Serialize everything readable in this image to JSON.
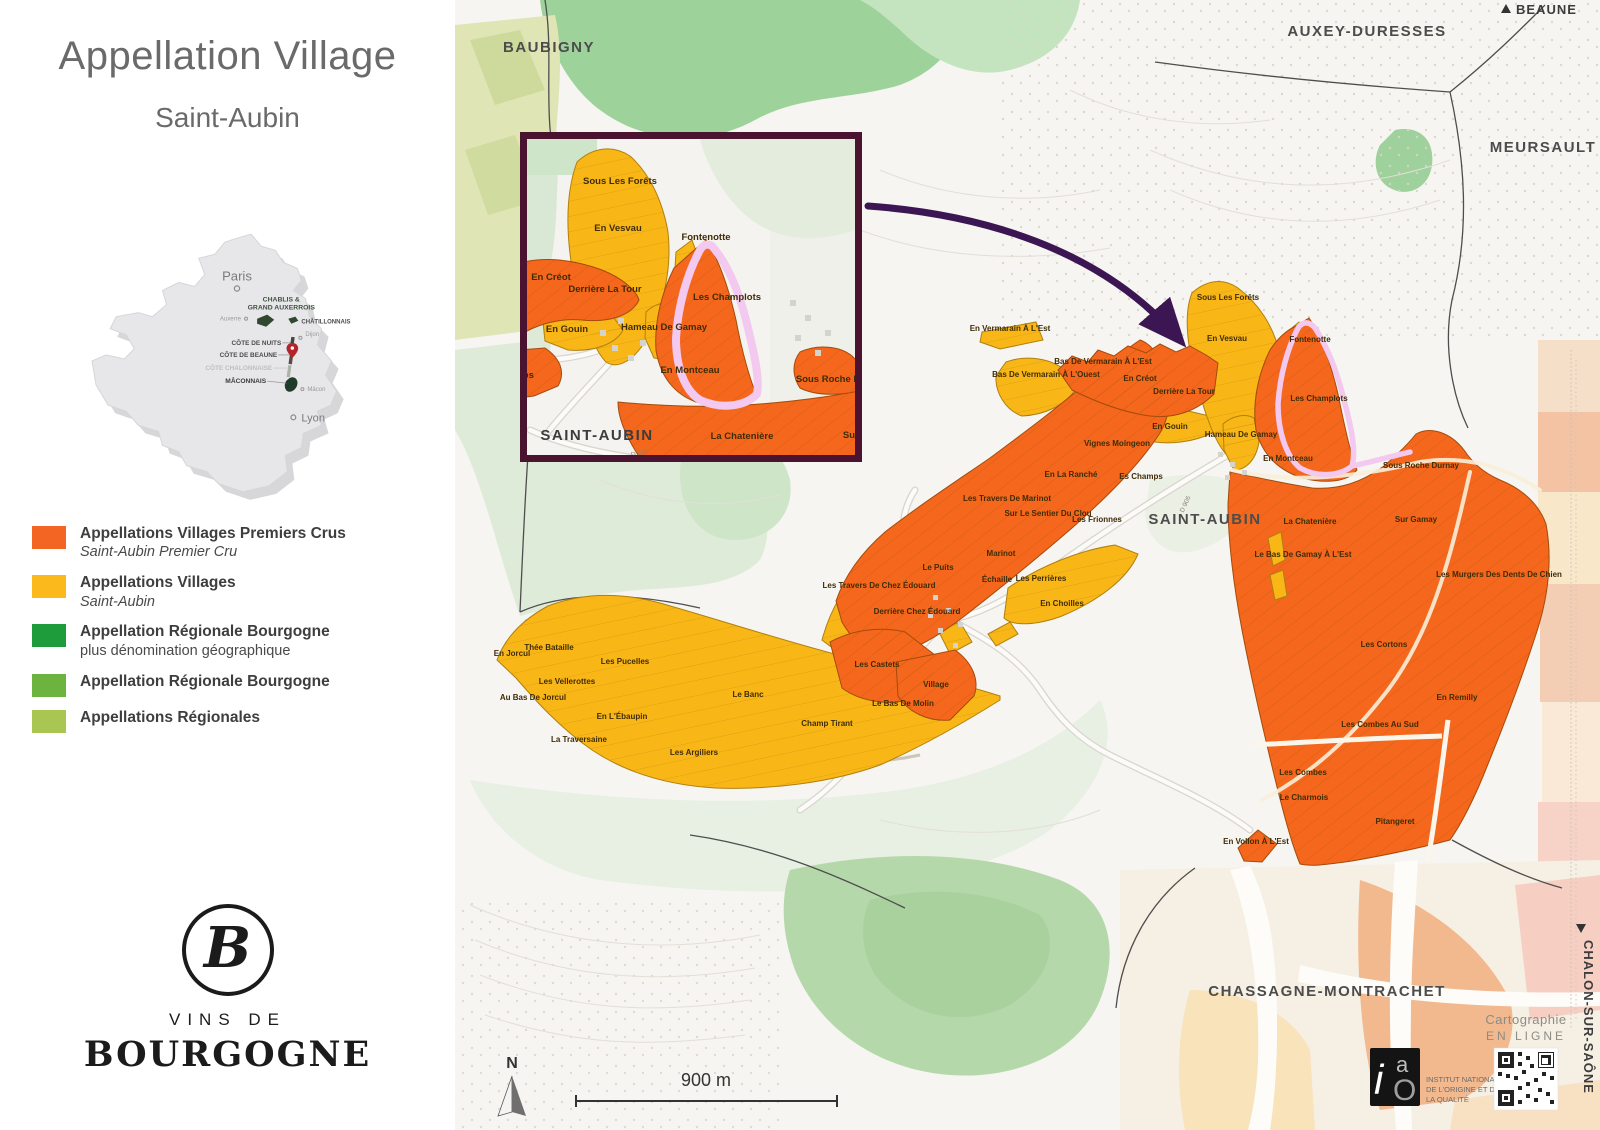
{
  "sidebar": {
    "title": "Appellation Village",
    "subtitle": "Saint-Aubin",
    "france": {
      "paris": "Paris",
      "lyon": "Lyon",
      "auxerre": "Auxerre",
      "dijon": "Dijon",
      "macon": "Mâcon",
      "chablis_line1": "CHABLIS &",
      "chablis_line2": "GRAND AUXERROIS",
      "chatillonnais": "CHÂTILLONNAIS",
      "cote_de_nuits": "CÔTE DE NUITS",
      "cote_de_beaune": "CÔTE DE BEAUNE",
      "cote_chalonnaise": "CÔTE CHALONNAISE",
      "maconnais": "MÂCONNAIS"
    },
    "legend": [
      {
        "color": "#F26522",
        "title": "Appellations Villages Premiers Crus",
        "subtitle": "Saint-Aubin Premier Cru",
        "subtitle_italic": true
      },
      {
        "color": "#FBB91C",
        "title": "Appellations Villages",
        "subtitle": "Saint-Aubin",
        "subtitle_italic": true
      },
      {
        "color": "#1E9C3B",
        "title": "Appellation Régionale Bourgogne",
        "subtitle": "plus dénomination géographique",
        "subtitle_italic": false
      },
      {
        "color": "#6CB33F",
        "title": "Appellation Régionale Bourgogne",
        "subtitle": "",
        "subtitle_italic": false
      },
      {
        "color": "#A9C653",
        "title": "Appellations Régionales",
        "subtitle": "",
        "subtitle_italic": false
      }
    ],
    "logo": {
      "monogram": "B",
      "line1": "VINS DE",
      "line2": "BOURGOGNE"
    }
  },
  "map": {
    "communes": {
      "baubigny": "BAUBIGNY",
      "auxey": "AUXEY-DURESSES",
      "meursault": "MEURSAULT",
      "saint_aubin": "SAINT-AUBIN",
      "chassagne": "CHASSAGNE-MONTRACHET"
    },
    "directions": {
      "beaune": "BEAUNE",
      "chalon": "CHALON-SUR-SAÔNE"
    },
    "scale_label": "900 m",
    "north_label": "N",
    "road_label": "D 906",
    "parcel_labels": [
      "En Vermarain À L'Est",
      "Bas De Vermarain À L'Ouest",
      "Bas De Vermarain À L'Est",
      "En Créot",
      "Derrière La Tour",
      "En Gouin",
      "Sous Les Forêts",
      "En Vesvau",
      "Fontenotte",
      "Les Champlots",
      "Hameau De Gamay",
      "En Montceau",
      "Sous Roche Durnay",
      "Es Champs",
      "Vignes Moingeon",
      "En La Ranché",
      "Les Travers De Marinot",
      "Sur Le Sentier Du Clou",
      "Les Frionnes",
      "Marinot",
      "Le Puits",
      "Échaille",
      "Les Perrières",
      "Les Travers De Chez Édouard",
      "Derrière Chez Édouard",
      "Les Castets",
      "Village",
      "Le Bas De Molin",
      "En Choilles",
      "En Jorcul",
      "Thée Bataille",
      "Les Pucelles",
      "Les Vellerottes",
      "Au Bas De Jorcul",
      "En L'Ébaupin",
      "La Traversaine",
      "Le Banc",
      "Les Argiliers",
      "Champ Tirant",
      "La Chatenière",
      "Sur Gamay",
      "Le Bas De Gamay À L'Est",
      "Les Murgers Des Dents De Chien",
      "Les Cortons",
      "En Remilly",
      "Les Combes Au Sud",
      "Les Combes",
      "Le Charmois",
      "Pitangeret",
      "En Vollon À L'Est"
    ],
    "inset": {
      "town": "SAINT-AUBIN",
      "road_label": "D 906",
      "labels": [
        "Sous Les Forêts",
        "En Vesvau",
        "En Créot",
        "Derrière La Tour",
        "En Gouin",
        "Fontenotte",
        "Les Champlots",
        "Hameau De Gamay",
        "En Montceau",
        "Sous Roche Durnay",
        "La Chatenière",
        "Sur Gamay",
        "Es Champs"
      ]
    },
    "credits": {
      "cartographie_line1": "Cartographie",
      "cartographie_line2": "EN LIGNE",
      "inao_line1": "INSTITUT NATIONAL",
      "inao_line2": "DE L'ORIGINE ET DE",
      "inao_line3": "LA QUALITÉ"
    },
    "colors": {
      "premier_cru": "#F4671C",
      "village": "#F9B717",
      "highlight_outline": "#F3C9EF",
      "arrow": "#3B1653",
      "inset_border": "#4A132F"
    }
  }
}
